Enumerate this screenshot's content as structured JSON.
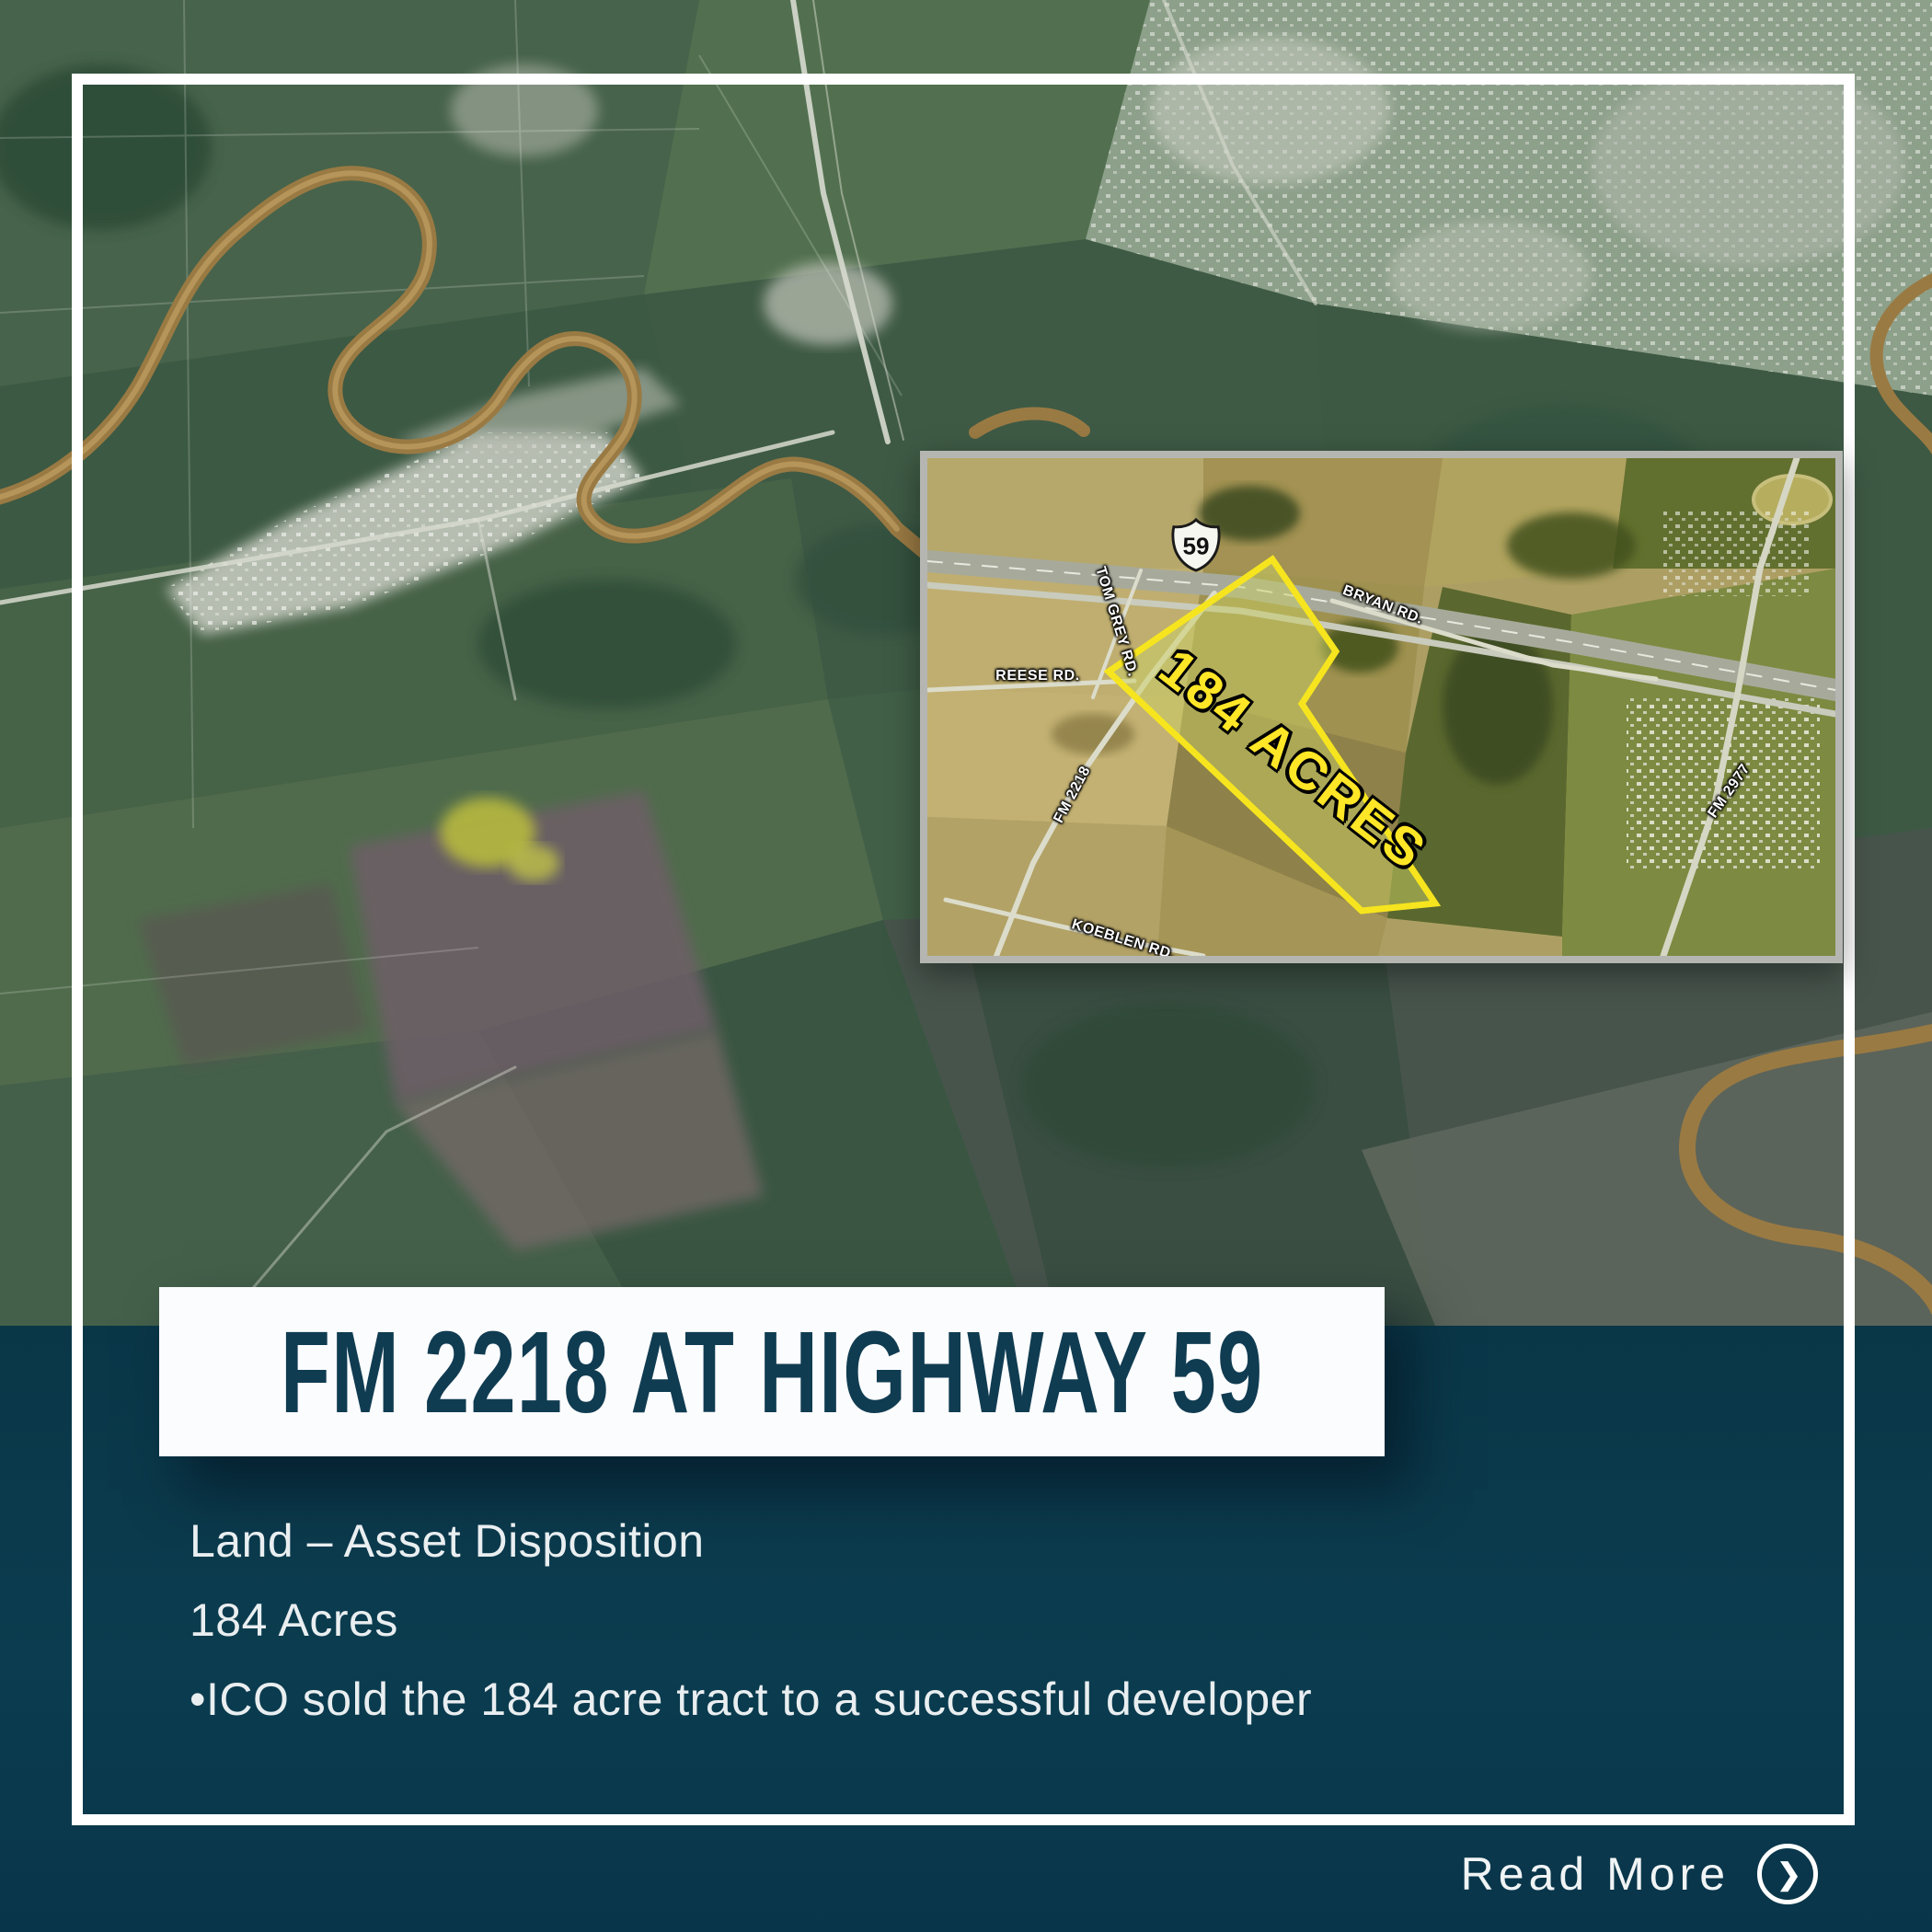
{
  "banner": {
    "title": "FM 2218 AT HIGHWAY 59"
  },
  "details": {
    "line1": "Land – Asset Disposition",
    "line2": "184 Acres",
    "line3": "•ICO sold the 184 acre tract to a successful developer"
  },
  "footer": {
    "read_more": "Read More"
  },
  "inset": {
    "shield": "59",
    "parcel": "184 ACRES",
    "roads": {
      "tom_grey": "TOM GREY RD.",
      "reese": "REESE RD.",
      "fm2218": "FM 2218",
      "koeblen": "KOEBLEN RD.",
      "bryan": "BRYAN RD.",
      "fm2977": "FM 2977"
    }
  },
  "colors": {
    "band_teal": "#0b3c4f",
    "banner_white": "#fbfcfd",
    "title_teal": "#103c52",
    "parcel_yellow": "#f6e51e",
    "frame_white": "#ffffff",
    "inset_border_gray": "#b5b6b2",
    "river_brown": "#9a7a43"
  }
}
